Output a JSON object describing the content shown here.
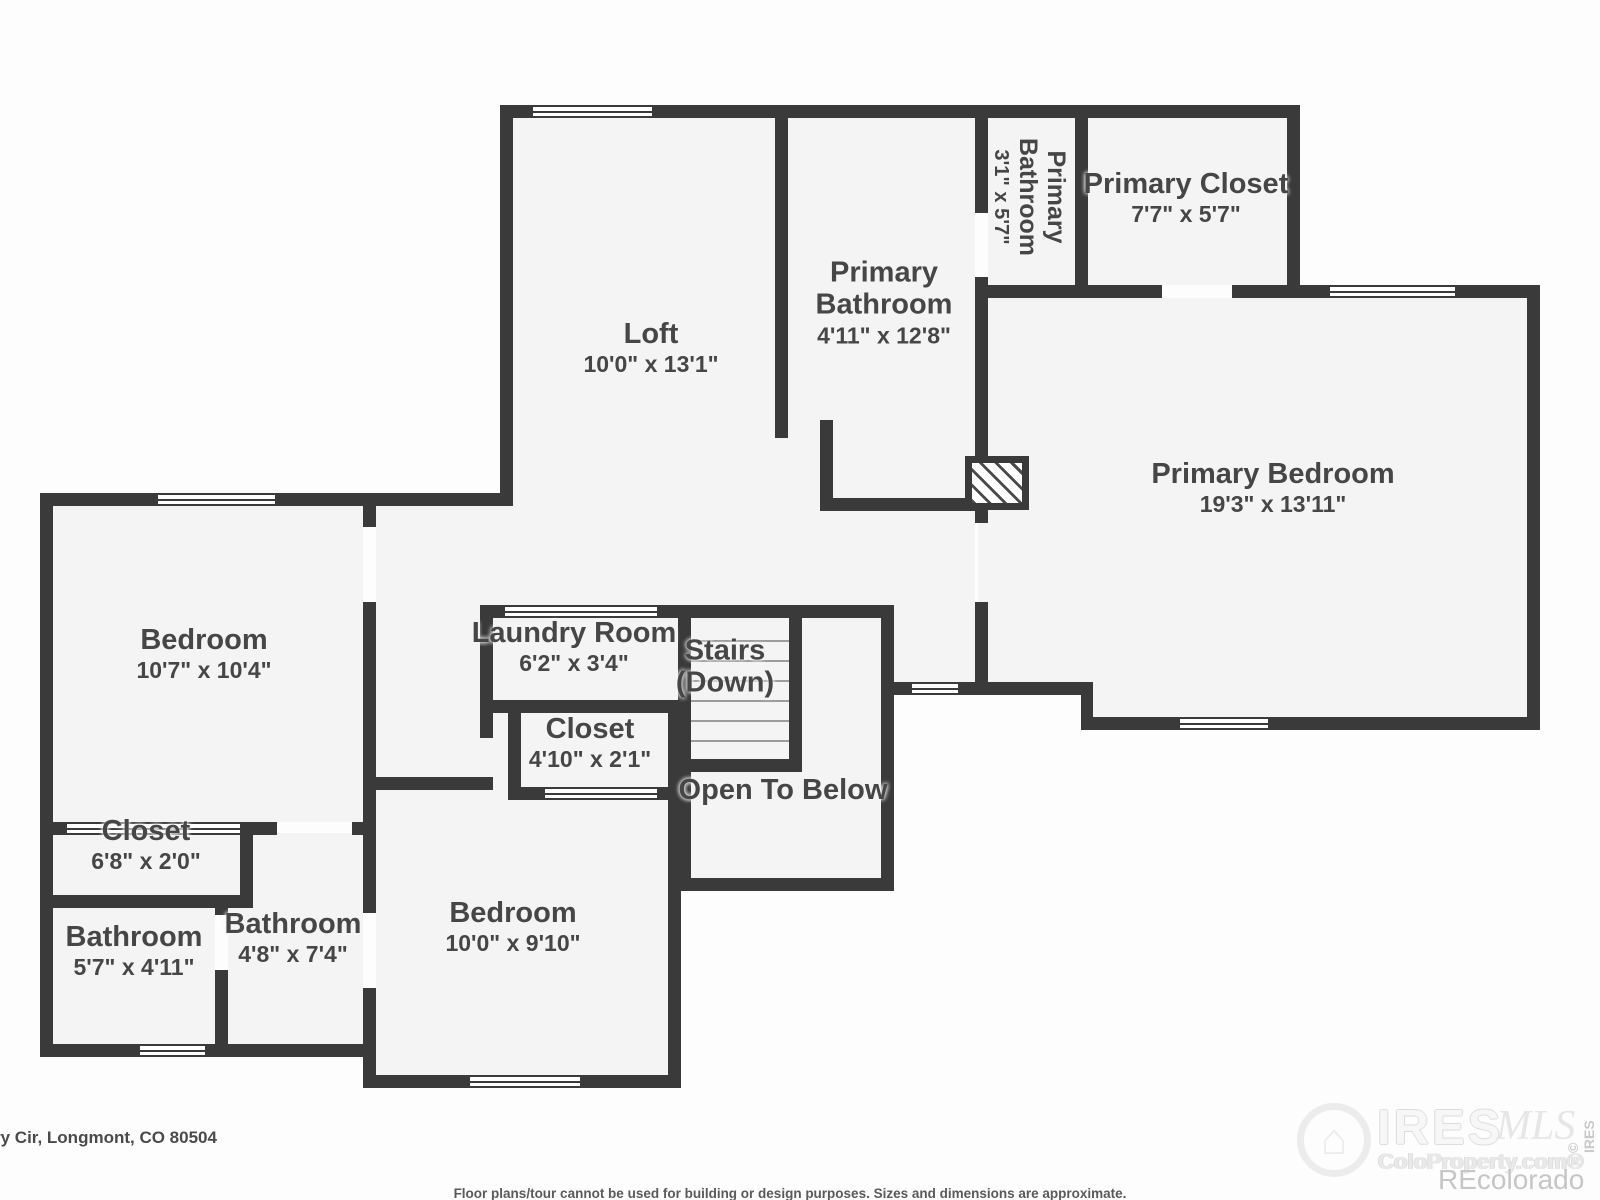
{
  "plan": {
    "rooms": [
      {
        "name": "Loft",
        "dims": "10'0\" x 13'1\""
      },
      {
        "name": "Primary Bathroom",
        "dims": "3'1\" x 5'7\""
      },
      {
        "name": "Primary Closet",
        "dims": "7'7\" x 5'7\""
      },
      {
        "name": "Primary Bathroom",
        "dims": "4'11\" x 12'8\""
      },
      {
        "name": "Primary Bedroom",
        "dims": "19'3\" x 13'11\""
      },
      {
        "name": "Bedroom",
        "dims": "10'7\" x 10'4\""
      },
      {
        "name": "Laundry Room",
        "dims": "6'2\" x 3'4\""
      },
      {
        "name": "Stairs",
        "dims": "(Down)"
      },
      {
        "name": "Closet",
        "dims": "4'10\" x 2'1\""
      },
      {
        "name": "Open To Below",
        "dims": ""
      },
      {
        "name": "Closet",
        "dims": "6'8\" x 2'0\""
      },
      {
        "name": "Bathroom",
        "dims": "5'7\" x 4'11\""
      },
      {
        "name": "Bathroom",
        "dims": "4'8\" x 7'4\""
      },
      {
        "name": "Bedroom",
        "dims": "10'0\" x 9'10\""
      }
    ],
    "footer": {
      "address": "ry Cir, Longmont, CO 80504",
      "disclaimer": "Floor plans/tour cannot be used for building or design purposes. Sizes and dimensions are approximate."
    },
    "watermark": {
      "brand": "IRES",
      "mls": "MLS",
      "house_icon": "⌂",
      "site": "ColoProperty.com®",
      "recolorado": "REcolorado",
      "copyright": "© IRES"
    },
    "colors": {
      "wall": "#3a3a3a",
      "room_fill": "#f4f4f4",
      "label": "#464646"
    }
  }
}
